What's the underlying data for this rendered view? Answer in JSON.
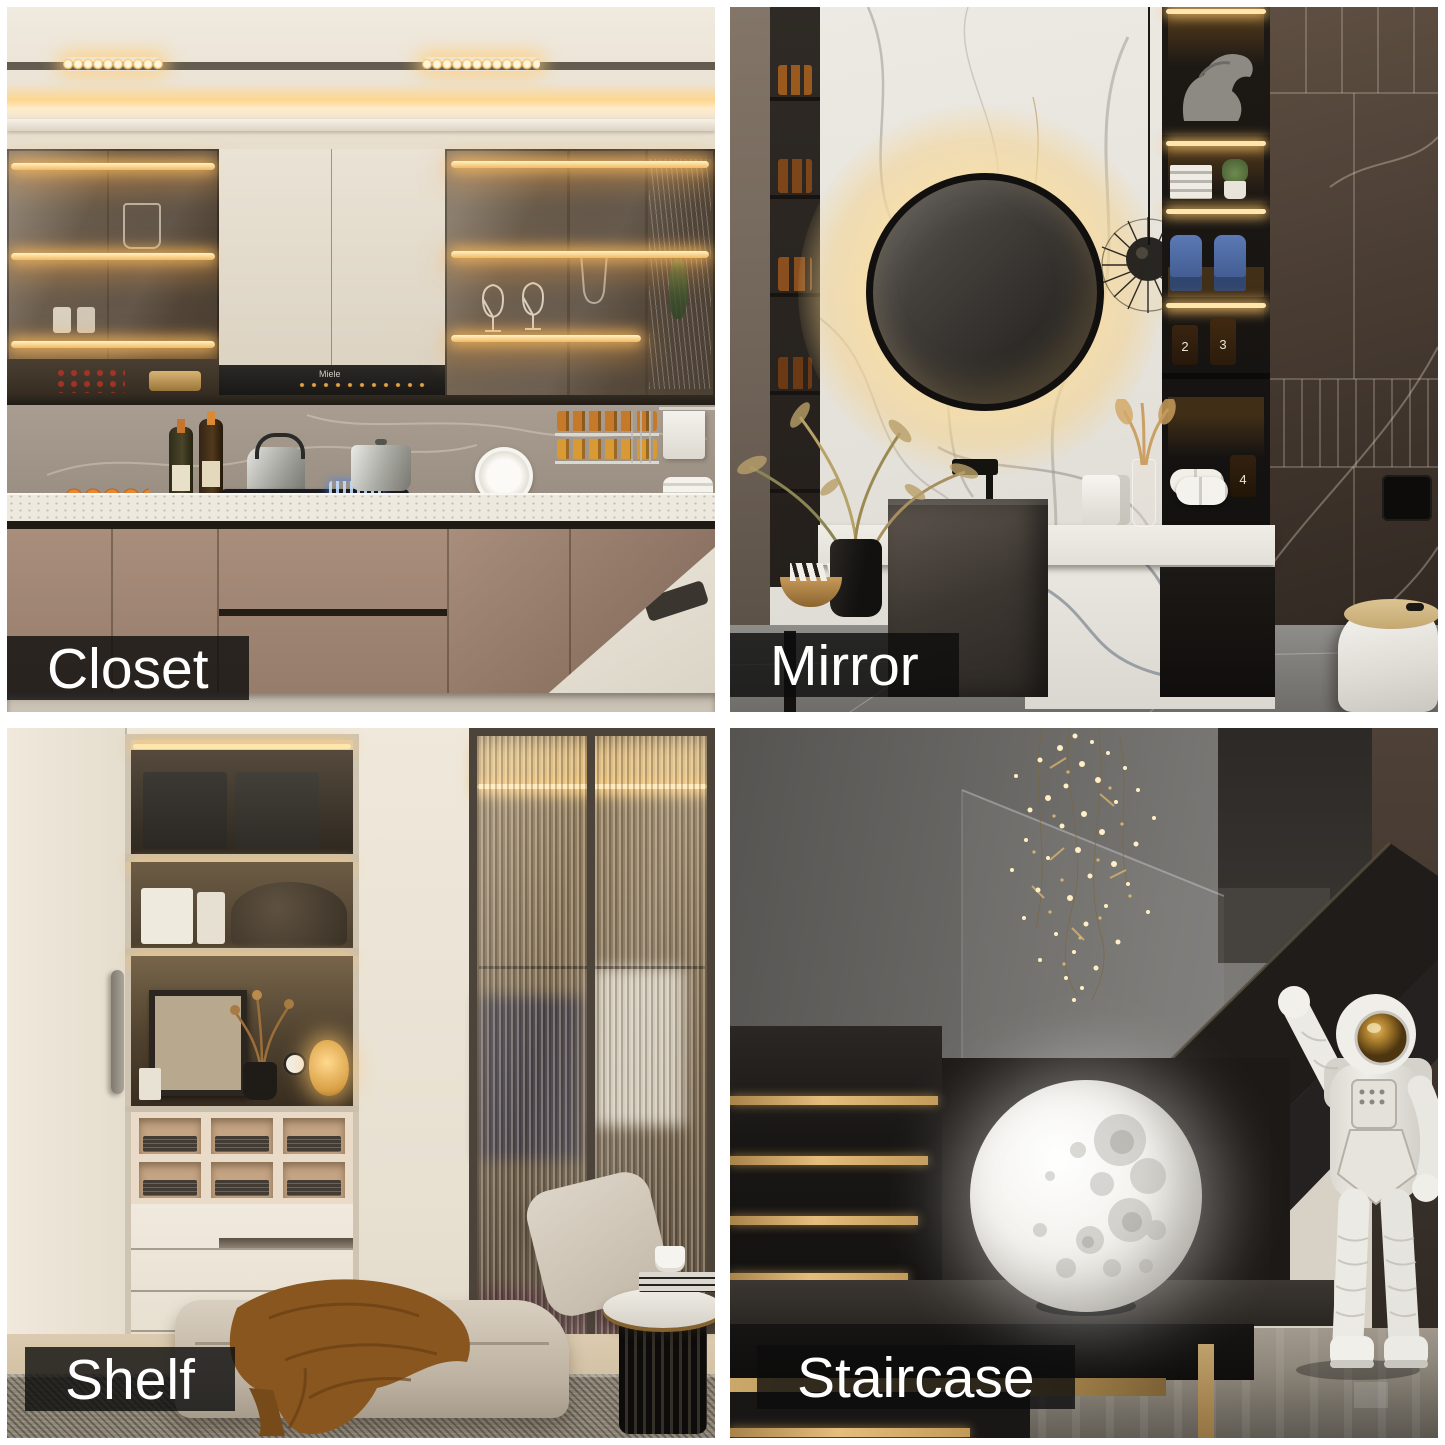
{
  "page": {
    "type": "interior design photo collage",
    "background": "#ffffff",
    "grid": {
      "rows": 2,
      "cols": 2,
      "gap_px": 15,
      "border_px": 7
    }
  },
  "panels": [
    {
      "label": "Closet",
      "position": "top-left"
    },
    {
      "label": "Mirror",
      "position": "top-right"
    },
    {
      "label": "Shelf",
      "position": "bottom-left"
    },
    {
      "label": "Staircase",
      "position": "bottom-right"
    }
  ],
  "label_style": {
    "background": "rgba(12,12,12,0.8)",
    "text_color": "#ffffff"
  },
  "kitchen": {
    "appliance_brand": "Miele"
  },
  "bathroom": {
    "bottle_numbers": [
      "2",
      "3",
      "4"
    ]
  },
  "palette": {
    "warm_led": "#f6c878",
    "gold_step": "#c29a58",
    "taupe_cabinet": "#a28877",
    "cream_wall": "#ece4d6",
    "brown_marble": "#4e4137",
    "moon_white": "#f4f3ef",
    "label_dark": "#0c0c0c"
  }
}
